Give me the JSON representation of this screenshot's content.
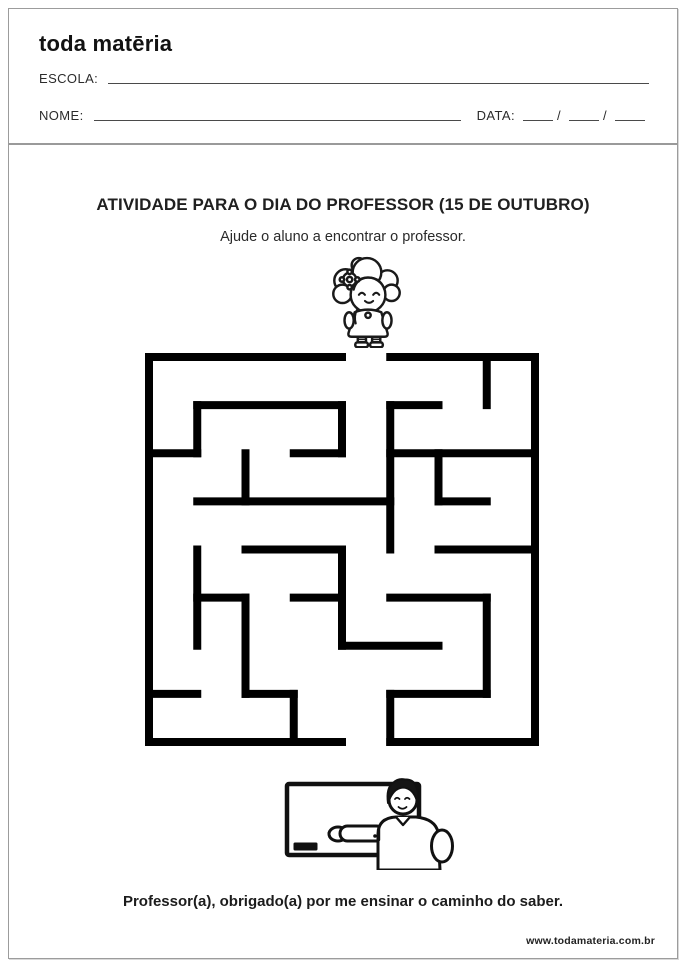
{
  "page": {
    "logo_text": "toda matēria",
    "header": {
      "school_label": "ESCOLA:",
      "name_label": "NOME:",
      "date_label": "DATA:",
      "date_slash": "/"
    },
    "activity": {
      "title": "ATIVIDADE PARA O DIA DO PROFESSOR (15 DE OUTUBRO)",
      "subtitle": "Ajude o aluno a encontrar o professor.",
      "message": "Professor(a), obrigado(a) por me ensinar o caminho do saber."
    },
    "footer_url": "www.todamateria.com.br",
    "colors": {
      "ink": "#1a1a1a",
      "wall_black": "#000000",
      "border_gray": "#9c9c9c",
      "paper": "#ffffff"
    },
    "maze": {
      "cols": 8,
      "rows": 8,
      "entrance": "top edge, 5th column",
      "exit": "bottom edge, 5th column",
      "wall_thickness": 8,
      "h_walls": [
        [
          0,
          0,
          4
        ],
        [
          0,
          5,
          8
        ],
        [
          1,
          1,
          4
        ],
        [
          1,
          5,
          6
        ],
        [
          2,
          0,
          1
        ],
        [
          2,
          3,
          4
        ],
        [
          2,
          5,
          8
        ],
        [
          3,
          1,
          5
        ],
        [
          3,
          6,
          7
        ],
        [
          4,
          2,
          4
        ],
        [
          4,
          6,
          8
        ],
        [
          5,
          1,
          2
        ],
        [
          5,
          3,
          4
        ],
        [
          5,
          5,
          7
        ],
        [
          6,
          4,
          6
        ],
        [
          7,
          0,
          1
        ],
        [
          7,
          2,
          3
        ],
        [
          7,
          5,
          7
        ],
        [
          8,
          0,
          4
        ],
        [
          8,
          5,
          8
        ]
      ],
      "v_walls": [
        [
          0,
          0,
          8
        ],
        [
          1,
          1,
          2
        ],
        [
          1,
          4,
          6
        ],
        [
          2,
          2,
          3
        ],
        [
          2,
          5,
          7
        ],
        [
          3,
          7,
          8
        ],
        [
          4,
          1,
          2
        ],
        [
          4,
          4,
          6
        ],
        [
          5,
          1,
          4
        ],
        [
          5,
          7,
          8
        ],
        [
          6,
          2,
          3
        ],
        [
          7,
          0,
          1
        ],
        [
          7,
          5,
          7
        ],
        [
          8,
          0,
          8
        ]
      ]
    }
  }
}
